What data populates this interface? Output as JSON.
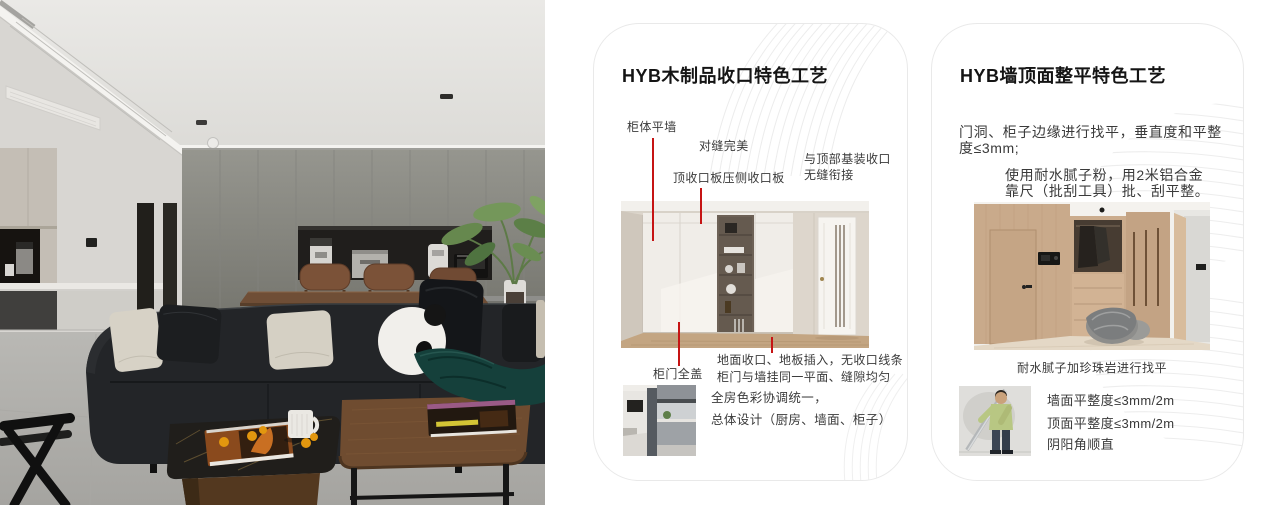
{
  "colors": {
    "annotation_red": "#c61414",
    "card_border": "#e9e9e9",
    "title_text": "#141414",
    "body_text": "#3a3a3a"
  },
  "cards": [
    {
      "title": "HYB木制品收口特色工艺",
      "labels": {
        "cabinet_flush_wall": "柜体平墙",
        "perfect_seam": "对缝完美",
        "top_closing_panel": "顶收口板压侧收口板",
        "ceiling_joint": [
          "与顶部基装收口",
          "无缝衔接"
        ],
        "full_cover_door": "柜门全盖"
      },
      "notes": [
        "地面收口、地板插入，无收口线条",
        "柜门与墙挂同一平面、缝隙均匀"
      ],
      "summary": [
        "全房色彩协调统一，",
        "总体设计（厨房、墙面、柜子）"
      ]
    },
    {
      "title": "HYB墙顶面整平特色工艺",
      "paragraph1": [
        "门洞、柜子边缘进行找平，垂直度和平整",
        "度≤3mm;"
      ],
      "paragraph2": [
        "使用耐水腻子粉，用2米铝合金",
        "靠尺（批刮工具）批、刮平整。"
      ],
      "image_caption": "耐水腻子加珍珠岩进行找平",
      "metrics": [
        "墙面平整度≤3mm/2m",
        "顶面平整度≤3mm/2m",
        "阴阳角顺直"
      ]
    }
  ]
}
